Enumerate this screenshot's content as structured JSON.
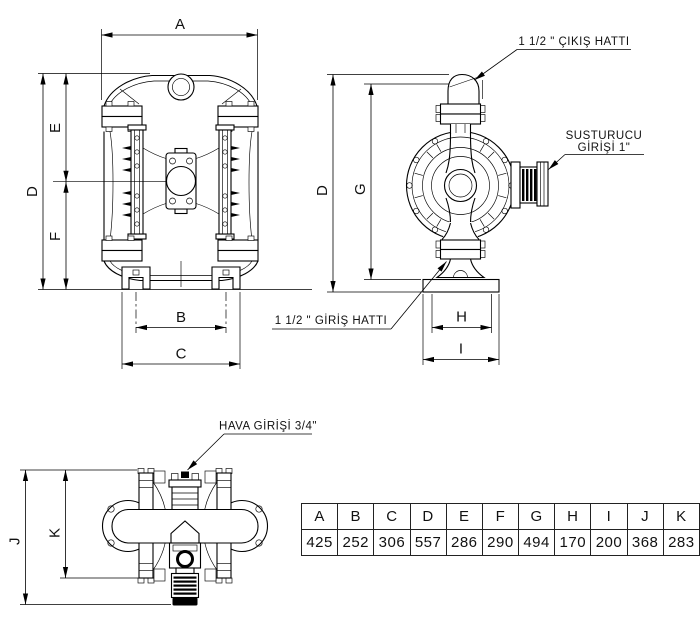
{
  "colors": {
    "line": "#000000",
    "background": "#ffffff",
    "text": "#111111"
  },
  "dimension_labels": {
    "a": "A",
    "b": "B",
    "c": "C",
    "d": "D",
    "e": "E",
    "f": "F",
    "g": "G",
    "h": "H",
    "i": "I",
    "j": "J",
    "k": "K"
  },
  "annotations": {
    "outlet_line": "1 1/2 \" ÇIKIŞ HATTI",
    "silencer_inlet_line1": "SUSTURUCU",
    "silencer_inlet_line2": "GİRİŞİ 1\"",
    "inlet_line": "1 1/2 \" GİRİŞ HATTI",
    "air_inlet": "HAVA GİRİŞİ 3/4\""
  },
  "dimension_table": {
    "headers": [
      "A",
      "B",
      "C",
      "D",
      "E",
      "F",
      "G",
      "H",
      "I",
      "J",
      "K"
    ],
    "values": [
      "425",
      "252",
      "306",
      "557",
      "286",
      "290",
      "494",
      "170",
      "200",
      "368",
      "283"
    ]
  }
}
